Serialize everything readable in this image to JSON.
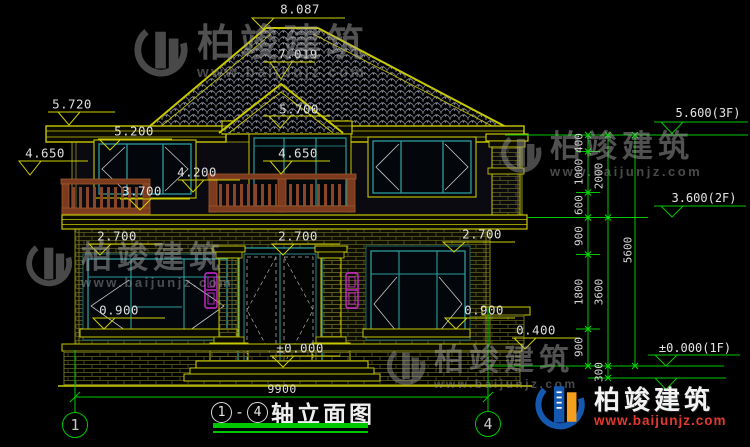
{
  "watermark": {
    "brand": "柏竣建筑",
    "url": "www.baijunjz.com"
  },
  "title_block": {
    "axis_from": "1",
    "axis_to": "4",
    "separator": "-",
    "title": "轴立面图"
  },
  "grid": {
    "bubble_left": "1",
    "bubble_right": "4",
    "overall_width": "9900"
  },
  "markers": {
    "ridge": "8.087",
    "gable_peak": "7.019",
    "left_eave": "5.720",
    "center_lintel": "5.700",
    "left_window_head": "5.200",
    "left_rail": "4.650",
    "balcony_rail": "4.650",
    "left_window_mid": "4.200",
    "left_window_sill": "3.700",
    "window_head_left": "2.700",
    "door_head": "2.700",
    "window_head_right": "2.700",
    "sill_left": "0.900",
    "sill_right": "0.900",
    "plinth": "0.400",
    "ground": "±0.000"
  },
  "levels": {
    "f3": "5.600(3F)",
    "f2": "3.600(2F)",
    "f1": "±0.000(1F)"
  },
  "vdims": {
    "d400": "400",
    "d1000": "1000",
    "d600": "600",
    "d900a": "900",
    "d1800": "1800",
    "d900b": "900",
    "d2000": "2000",
    "d3600": "3600",
    "d300": "300",
    "d5600": "5600"
  }
}
